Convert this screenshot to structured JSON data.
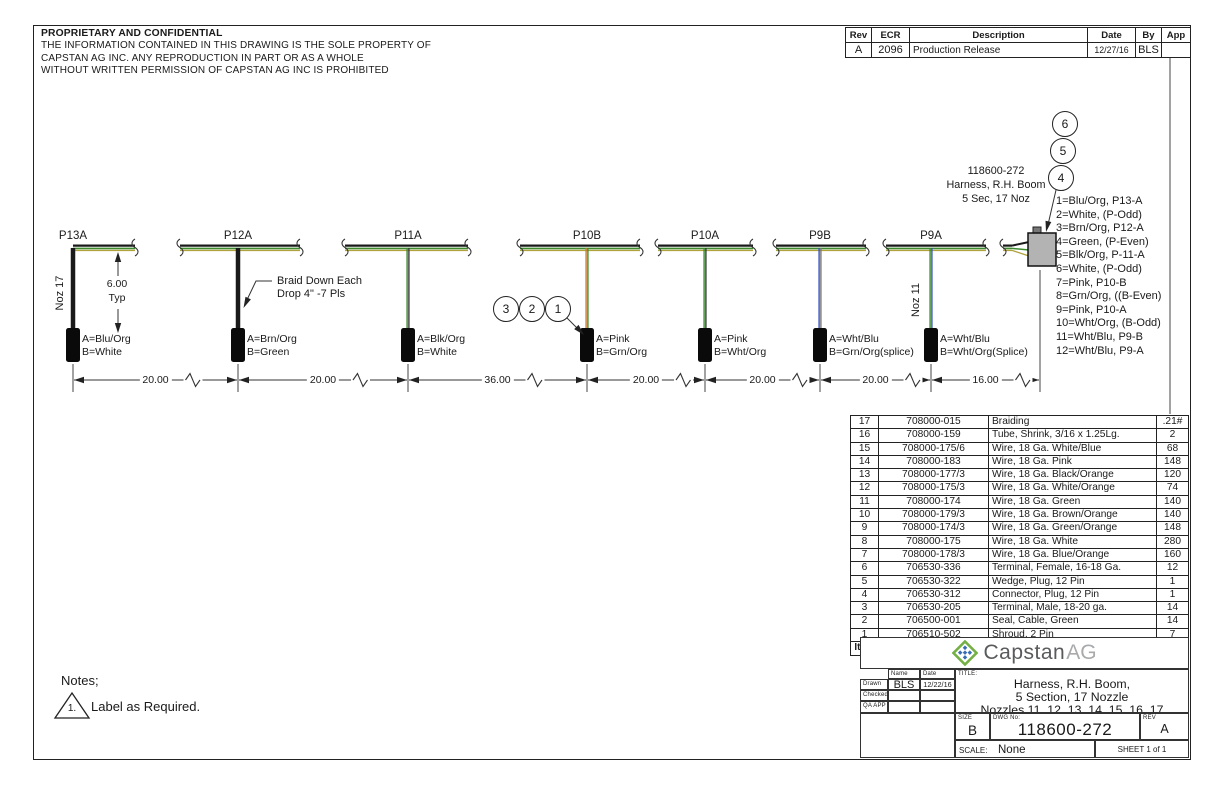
{
  "proprietary": {
    "title": "PROPRIETARY AND CONFIDENTIAL",
    "lines": [
      "THE INFORMATION CONTAINED IN THIS DRAWING IS THE SOLE PROPERTY OF",
      "CAPSTAN AG INC. ANY REPRODUCTION IN PART OR AS A WHOLE",
      "WITHOUT WRITTEN PERMISSION OF CAPSTAN AG INC IS PROHIBITED"
    ]
  },
  "revision_table": {
    "headers": [
      "Rev",
      "ECR",
      "Description",
      "Date",
      "By",
      "App"
    ],
    "rows": [
      [
        "A",
        "2096",
        "Production Release",
        "12/27/16",
        "BLS",
        ""
      ]
    ]
  },
  "harness": {
    "connector_label": [
      "118600-272",
      "Harness, R.H. Boom",
      "5 Sec, 17 Noz"
    ],
    "braid_note": [
      "Braid Down Each",
      "Drop 4\" -7 Pls"
    ],
    "noz_left": "Noz 17",
    "noz_right": "Noz 11",
    "typ_dim": {
      "value": "6.00",
      "label": "Typ"
    },
    "drops": [
      {
        "label": "P13A",
        "a": "A=Blu/Org",
        "b": "B=White"
      },
      {
        "label": "P12A",
        "a": "A=Brn/Org",
        "b": "B=Green"
      },
      {
        "label": "P11A",
        "a": "A=Blk/Org",
        "b": "B=White"
      },
      {
        "label": "P10B",
        "a": "A=Pink",
        "b": "B=Grn/Org"
      },
      {
        "label": "P10A",
        "a": "A=Pink",
        "b": "B=Wht/Org"
      },
      {
        "label": "P9B",
        "a": "A=Wht/Blu",
        "b": "B=Grn/Org(splice)"
      },
      {
        "label": "P9A",
        "a": "A=Wht/Blu",
        "b": "B=Wht/Org(Splice)"
      }
    ],
    "dimensions": [
      "20.00",
      "20.00",
      "36.00",
      "20.00",
      "20.00",
      "20.00",
      "16.00"
    ],
    "callouts_left": [
      "3",
      "2",
      "1"
    ],
    "callouts_right": [
      "6",
      "5",
      "4"
    ],
    "pin_list": [
      "1=Blu/Org, P13-A",
      "2=White, (P-Odd)",
      "3=Brn/Org, P12-A",
      "4=Green, (P-Even)",
      "5=Blk/Org, P-11-A",
      "6=White, (P-Odd)",
      "7=Pink, P10-B",
      "8=Grn/Org, ((B-Even)",
      "9=Pink, P10-A",
      "10=Wht/Org, (B-Odd)",
      "11=Wht/Blu, P9-B",
      "12=Wht/Blu, P9-A"
    ]
  },
  "bom": {
    "headers": [
      "Item",
      "Part Number",
      "Description",
      "Qty"
    ],
    "rows": [
      [
        "17",
        "708000-015",
        "Braiding",
        ".21#"
      ],
      [
        "16",
        "708000-159",
        "Tube, Shrink, 3/16 x 1.25Lg.",
        "2"
      ],
      [
        "15",
        "708000-175/6",
        "Wire, 18 Ga. White/Blue",
        "68"
      ],
      [
        "14",
        "708000-183",
        "Wire, 18 Ga. Pink",
        "148"
      ],
      [
        "13",
        "708000-177/3",
        "Wire, 18 Ga. Black/Orange",
        "120"
      ],
      [
        "12",
        "708000-175/3",
        "Wire, 18 Ga. White/Orange",
        "74"
      ],
      [
        "11",
        "708000-174",
        "Wire, 18 Ga. Green",
        "140"
      ],
      [
        "10",
        "708000-179/3",
        "Wire, 18 Ga. Brown/Orange",
        "140"
      ],
      [
        "9",
        "708000-174/3",
        "Wire, 18 Ga. Green/Orange",
        "148"
      ],
      [
        "8",
        "708000-175",
        "Wire, 18 Ga. White",
        "280"
      ],
      [
        "7",
        "708000-178/3",
        "Wire, 18 Ga. Blue/Orange",
        "160"
      ],
      [
        "6",
        "706530-336",
        "Terminal, Female, 16-18 Ga.",
        "12"
      ],
      [
        "5",
        "706530-322",
        "Wedge, Plug, 12 Pin",
        "1"
      ],
      [
        "4",
        "706530-312",
        "Connector, Plug, 12 Pin",
        "1"
      ],
      [
        "3",
        "706530-205",
        "Terminal, Male, 18-20 ga.",
        "14"
      ],
      [
        "2",
        "706500-001",
        "Seal, Cable, Green",
        "14"
      ],
      [
        "1",
        "706510-502",
        "Shroud, 2 Pin",
        "7"
      ]
    ]
  },
  "title_block": {
    "logo_word": "Capstan",
    "logo_suffix": "AG",
    "name_label": "Name",
    "date_label": "Date",
    "drawn_label": "Drawn",
    "checked_label": "Checked",
    "qa_label": "QA APP",
    "drawn_name": "BLS",
    "drawn_date": "12/22/16",
    "title_label": "TITLE:",
    "title_lines": [
      "Harness, R.H. Boom,",
      "5 Section, 17 Nozzle",
      "Nozzles 11, 12, 13, 14, 15, 16, 17"
    ],
    "size_label": "SIZE",
    "size": "B",
    "dwg_label": "DWG No:",
    "dwg_no": "118600-272",
    "rev_label": "REV",
    "rev": "A",
    "scale_label": "SCALE:",
    "scale": "None",
    "sheet": "SHEET 1 of 1"
  },
  "notes": {
    "heading": "Notes;",
    "items": [
      {
        "marker": "1.",
        "text": "Label as Required."
      }
    ]
  },
  "colors": {
    "wire_green": "#3c8c2f",
    "wire_olive": "#b0a23c",
    "wire_orange": "#c87d2e",
    "wire_blue": "#3a50c0",
    "connector_gray": "#b3b3b3",
    "line_black": "#1a1a1a",
    "logo_green": "#74b043",
    "logo_blue": "#3a6cb4"
  }
}
